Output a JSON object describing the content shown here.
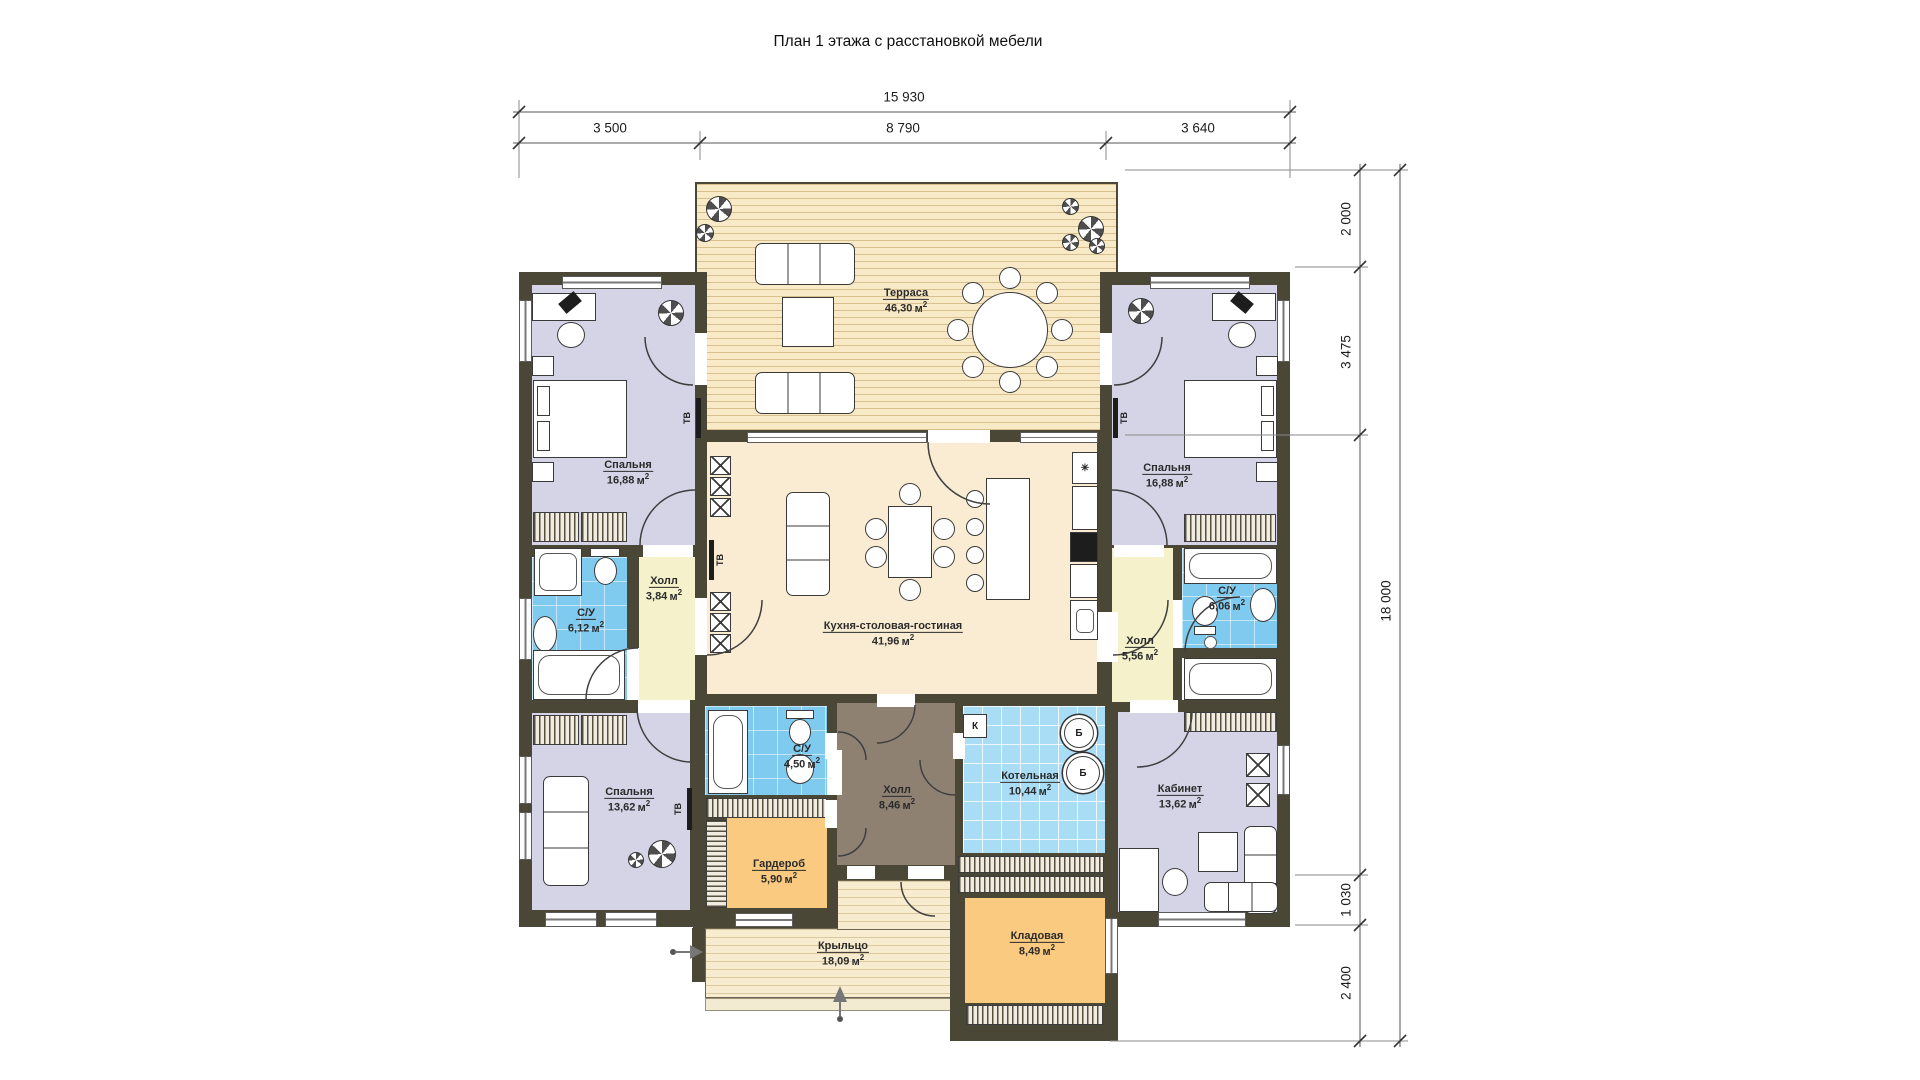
{
  "title": "План 1 этажа с расстановкой мебели",
  "unit": "м",
  "unit_sup": "2",
  "dims": {
    "top_total": "15 930",
    "top_segs": [
      "3 500",
      "8 790",
      "3 640"
    ],
    "right_total": "18 000",
    "right_segs": [
      "2 000",
      "3 475",
      "1 030",
      "2 400"
    ]
  },
  "rooms": {
    "terrace": {
      "name": "Терраса",
      "area": "46,30"
    },
    "bedroom_tl": {
      "name": "Спальня",
      "area": "16,88"
    },
    "bedroom_tr": {
      "name": "Спальня",
      "area": "16,88"
    },
    "hall_small": {
      "name": "Холл",
      "area": "3,84"
    },
    "su_left": {
      "name": "С/У",
      "area": "6,12"
    },
    "kitchen": {
      "name": "Кухня-столовая-гостиная",
      "area": "41,96"
    },
    "hall_right": {
      "name": "Холл",
      "area": "5,56"
    },
    "su_right": {
      "name": "С/У",
      "area": "6,06"
    },
    "bedroom_bl": {
      "name": "Спальня",
      "area": "13,62"
    },
    "su_center": {
      "name": "С/У",
      "area": "4,50"
    },
    "hall_entry": {
      "name": "Холл",
      "area": "8,46"
    },
    "boiler_room": {
      "name": "Котельная",
      "area": "10,44"
    },
    "cabinet": {
      "name": "Кабинет",
      "area": "13,62"
    },
    "wardrobe": {
      "name": "Гардероб",
      "area": "5,90"
    },
    "storage": {
      "name": "Кладовая",
      "area": "8,49"
    },
    "porch": {
      "name": "Крыльцо",
      "area": "18,09"
    }
  },
  "marks": {
    "tv": "ТВ",
    "boiler": "Б",
    "k": "К",
    "snowflake": "✳"
  }
}
